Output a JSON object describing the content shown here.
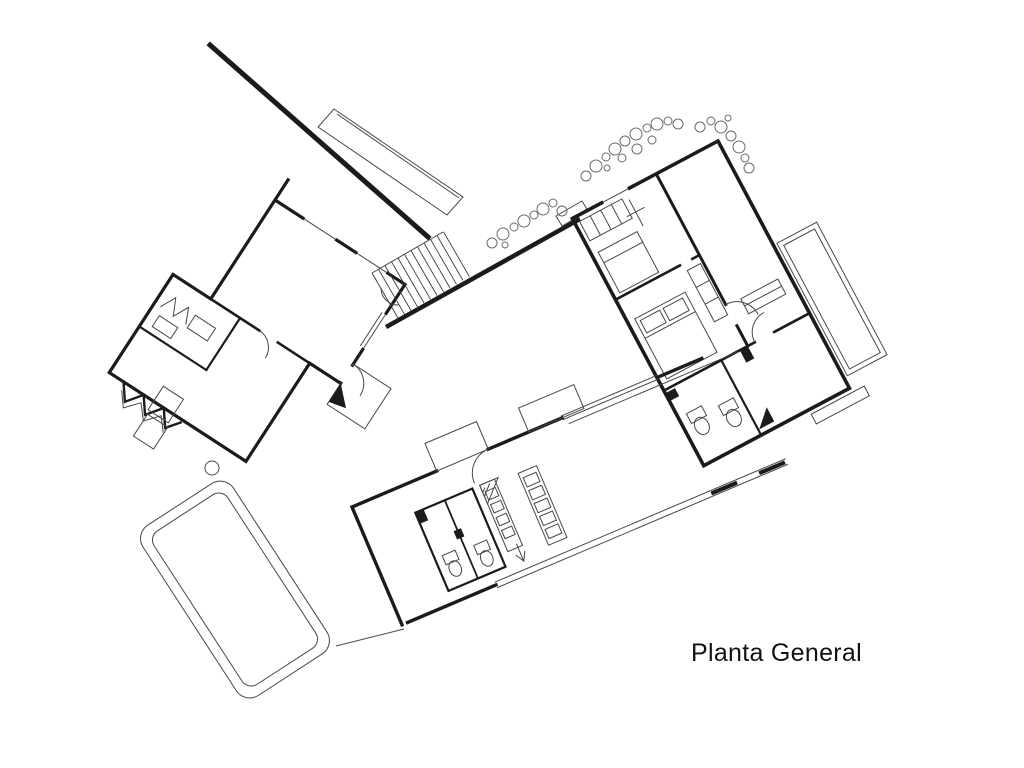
{
  "slide": {
    "background_color": "#ffffff",
    "ink_color": "#1b1b1b",
    "vegetation_color": "#6b6b6b"
  },
  "caption": {
    "text": "Planta General"
  },
  "drawing": {
    "kind": "architectural-site-plan",
    "elements": [
      "boundary-wall",
      "carport-wing",
      "guest-house",
      "staircase",
      "garden-wall",
      "main-house",
      "bedrooms",
      "terrace",
      "service-wing",
      "kitchen",
      "bathrooms",
      "swimming-pool",
      "vegetation-bubbles"
    ]
  }
}
